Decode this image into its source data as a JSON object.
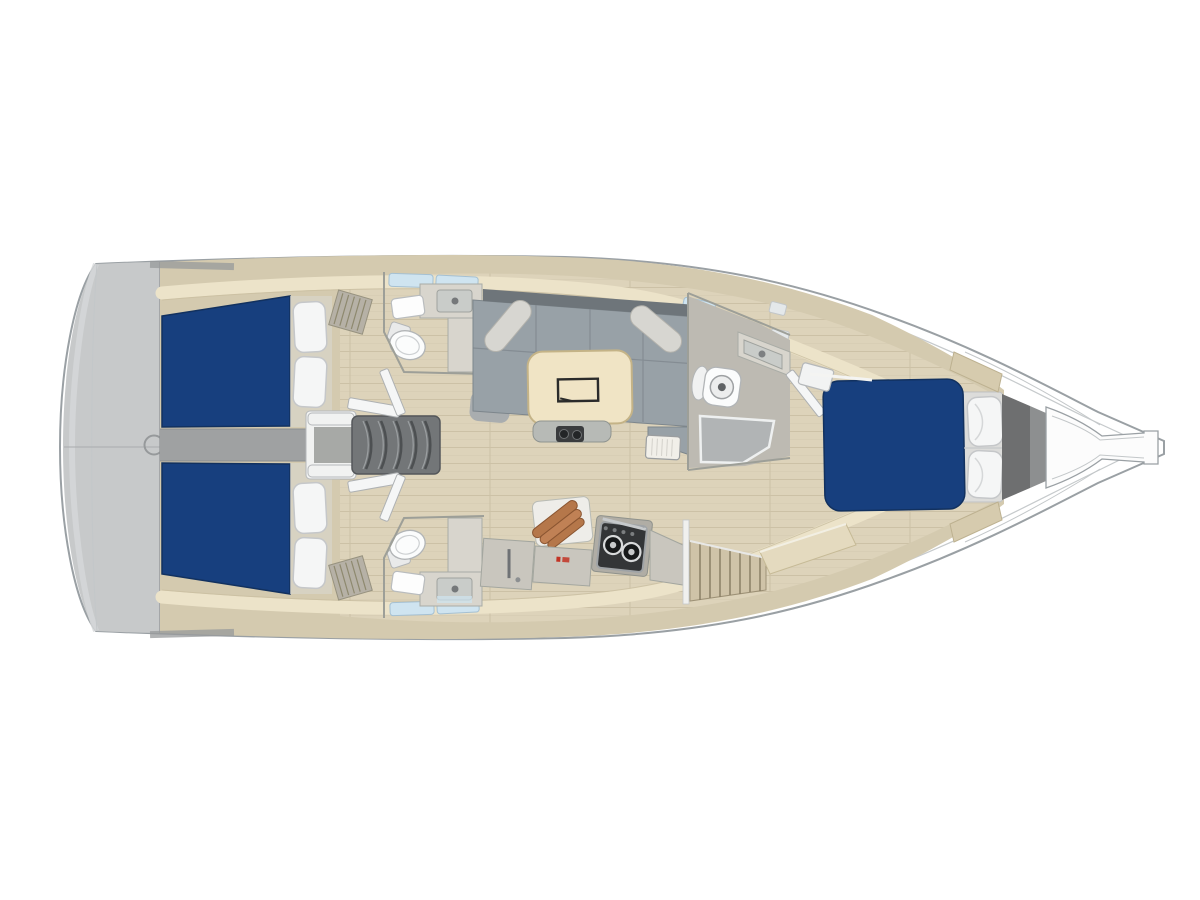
{
  "meta": {
    "title": "Sailing yacht interior floor plan, top view with bow to the right",
    "view": "top-down rendering",
    "orientation": "bow-right"
  },
  "legend": {
    "rooms": [
      {
        "name": "stern-platform",
        "features": "gray transom deck with round hatch"
      },
      {
        "name": "aft-cabin-top",
        "features": "double berth, navy mattress, 2 pillows"
      },
      {
        "name": "aft-cabin-bottom",
        "features": "double berth, navy mattress, 2 pillows"
      },
      {
        "name": "companionway",
        "features": "5-tread steps flanked by white rails"
      },
      {
        "name": "head-aft-top",
        "features": "toilet, sink counter, louvered grate"
      },
      {
        "name": "head-aft-bottom",
        "features": "toilet, sink counter, louvered grate"
      },
      {
        "name": "salon",
        "features": "U-shaped gray sofa, 2 bolster cushions, wood dining table"
      },
      {
        "name": "galley",
        "features": "two-burner stove, cutting board with copper pans, cabinet"
      },
      {
        "name": "head-forward",
        "features": "toilet, sink, shower tray"
      },
      {
        "name": "wardrobe",
        "features": "louvered hanging locker"
      },
      {
        "name": "forward-cabin",
        "features": "island double berth, navy mattress, 2 pillows"
      },
      {
        "name": "anchor-locker",
        "features": "dark bulkhead wedge"
      },
      {
        "name": "bowsprit",
        "features": "tapered bow fitting"
      }
    ]
  },
  "counts": {
    "cabins": 3,
    "heads": 3,
    "berths": 3,
    "pillows_total": 6,
    "sofa_bolsters": 2,
    "stove_burners": 2
  },
  "colors": {
    "bg": "#ffffff",
    "hull_fill": "#ffffff",
    "hull_stroke": "#9aa0a4",
    "hull_inner": "#c6cacc",
    "deck_gray": "#c7c9ca",
    "interior_tan": "#d4caaf",
    "cream_band": "#ece3c9",
    "cream_edge": "#c9bea0",
    "floor_wood": "#ddd3ba",
    "floor_line": "#c8bda1",
    "bed_navy": "#173f7e",
    "pillow_white": "#f5f6f6",
    "pillow_stroke": "#c5c7c9",
    "corridor_gray": "#9fa1a2",
    "steps_dark": "#737678",
    "step_line": "#4d5052",
    "white_trim": "#f1f2f1",
    "sofa_gray": "#98a1a7",
    "sofa_dark": "#6e757a",
    "sofa_line": "#7d868c",
    "bolster": "#d7d6d1",
    "table_wood": "#f0e4c5",
    "table_stroke": "#c4b387",
    "furniture_light": "#d8d5cd",
    "furniture_mid": "#c9c6be",
    "basin_gray": "#c9ccc9",
    "toilet_white": "#fbfcfc",
    "fixture_stroke": "#b2b5b7",
    "wall_line": "#9d9f98",
    "shower_gray": "#b1b4b5",
    "mat_gray": "#a9adaf",
    "stove_dark": "#333537",
    "metal_gray": "#9fa3a6",
    "copper": "#b5774a",
    "copper_dark": "#8a5531",
    "window_blue": "#cfe4f0",
    "window_stroke": "#a5c0d2",
    "window_gray": "#e4e8ea",
    "wardrobe_tan": "#cfc3a8",
    "slat_line": "#8a7f66",
    "anchor_dark": "#6e6f70",
    "anchor_mid": "#8d8f90",
    "red_mark": "#c23324"
  }
}
